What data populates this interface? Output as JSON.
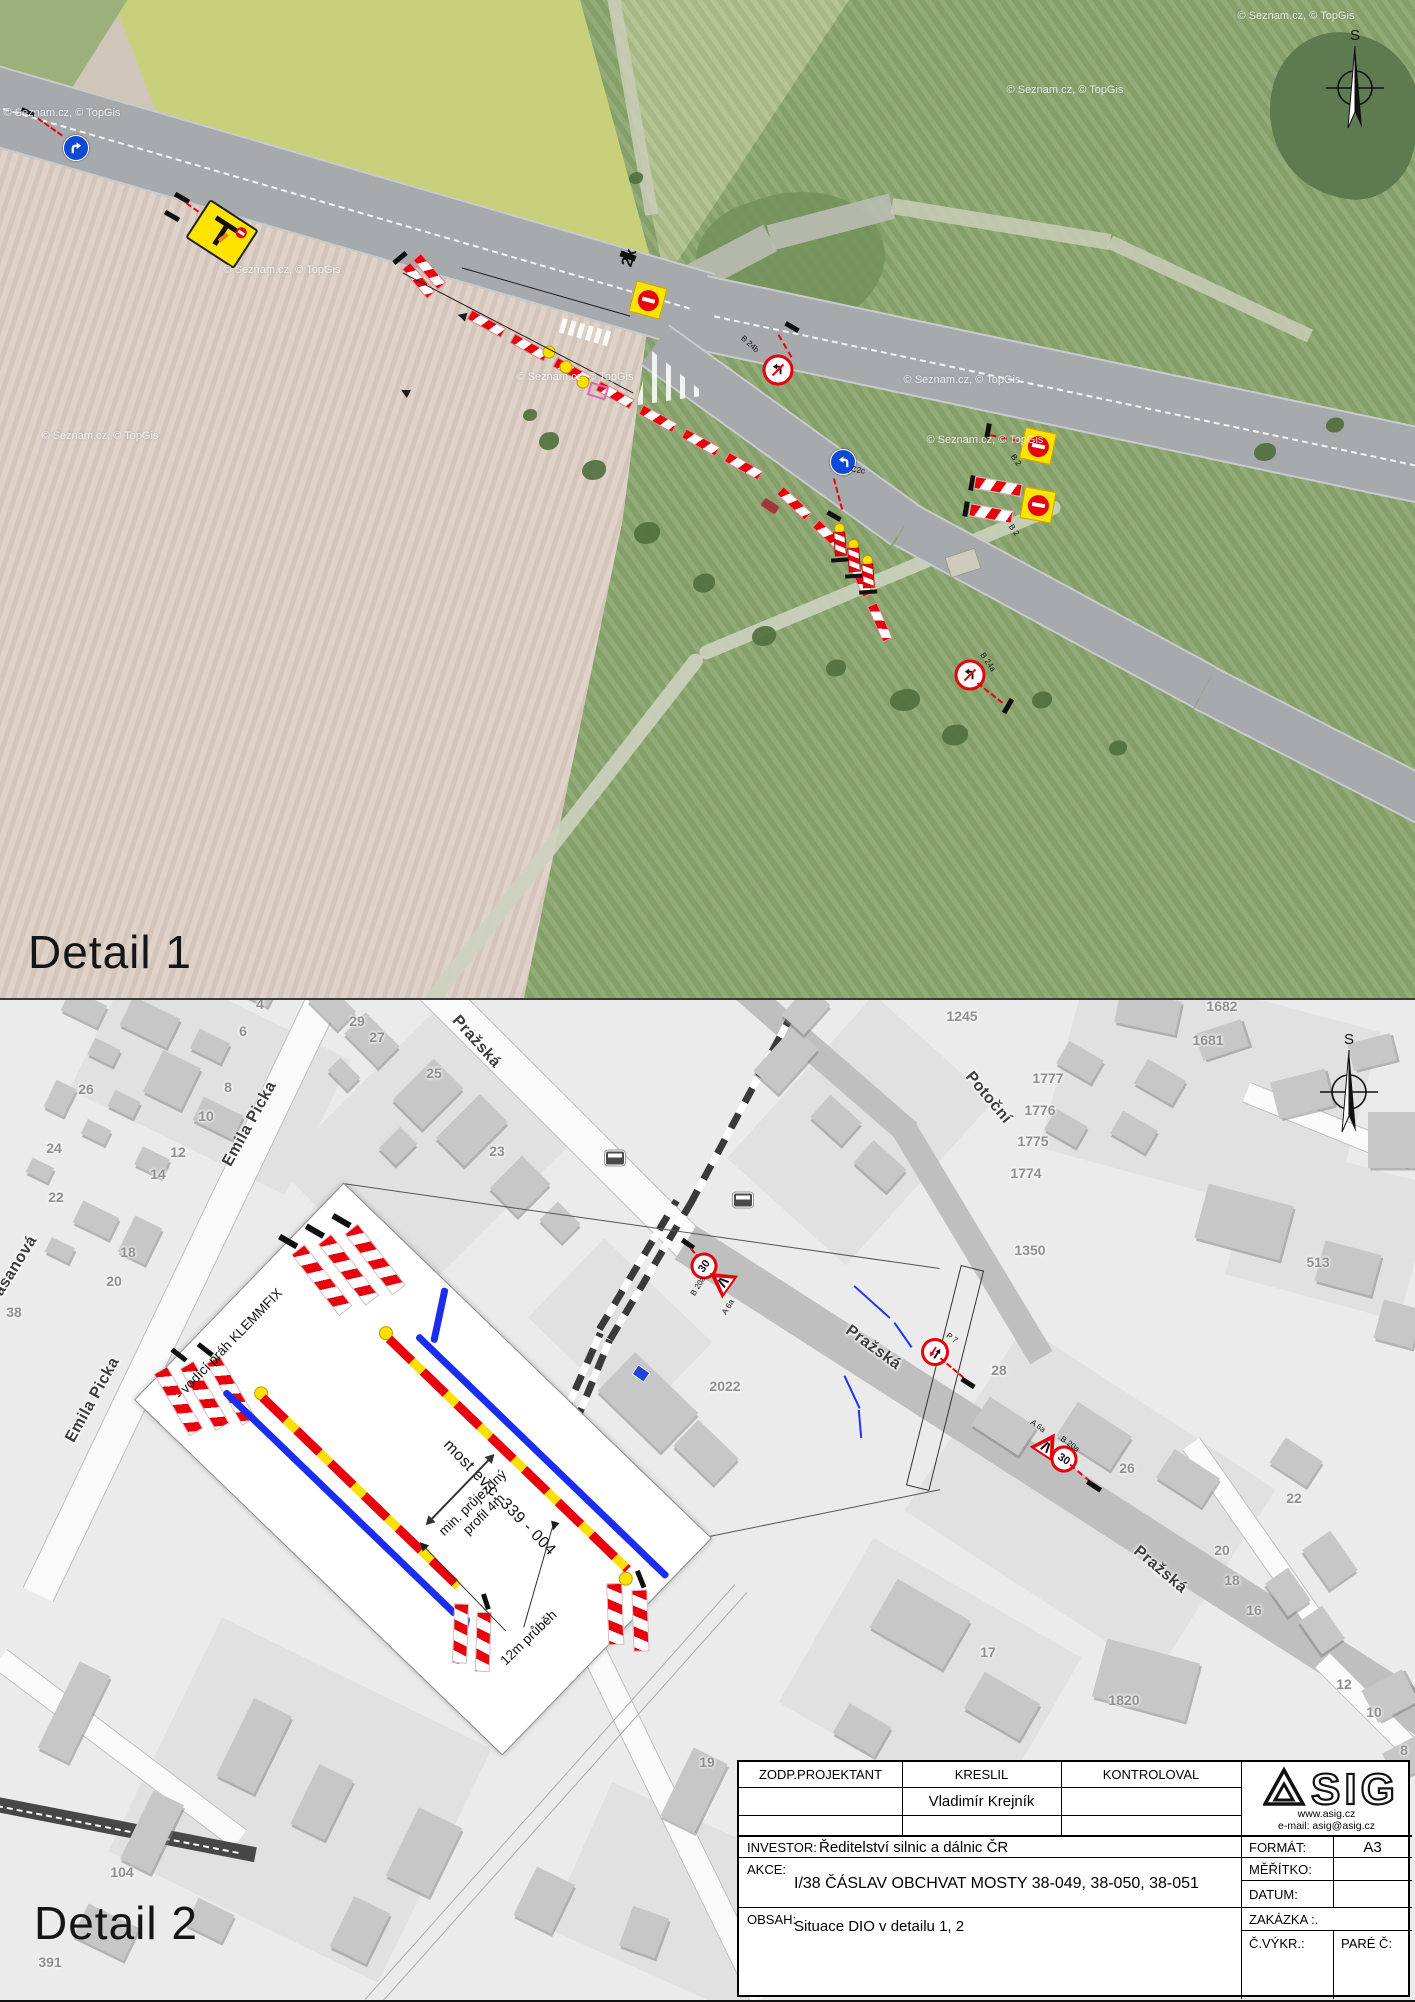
{
  "page": {
    "width": 1415,
    "height": 2000
  },
  "detail1": {
    "title": "Detail 1",
    "compass_label": "S",
    "watermarks": [
      {
        "text": "© Seznam.cz, © TopGis",
        "x": 62,
        "y": 113
      },
      {
        "text": "© Seznam.cz, © TopGis",
        "x": 282,
        "y": 270
      },
      {
        "text": "© Seznam.cz, © TopGis",
        "x": 100,
        "y": 436
      },
      {
        "text": "© Seznam.cz, © TopGis",
        "x": 575,
        "y": 377
      },
      {
        "text": "© Seznam.cz, © TopGis",
        "x": 985,
        "y": 440
      },
      {
        "text": "© Seznam.cz, © TopGis",
        "x": 1065,
        "y": 90
      },
      {
        "text": "© Seznam.cz, © TopGis",
        "x": 1296,
        "y": 16
      },
      {
        "text": "© Seznam.cz, © TopGis",
        "x": 962,
        "y": 380
      }
    ],
    "sign_codes": [
      {
        "text": "2x",
        "x": 630,
        "y": 258,
        "rot": -72,
        "size": 16,
        "bold": true
      },
      {
        "text": "B 24b",
        "x": 750,
        "y": 344,
        "rot": 42,
        "size": 8
      },
      {
        "text": "C2c",
        "x": 858,
        "y": 470,
        "rot": 10,
        "size": 8
      },
      {
        "text": "B 2",
        "x": 1016,
        "y": 460,
        "rot": 55,
        "size": 8
      },
      {
        "text": "B 2",
        "x": 1014,
        "y": 530,
        "rot": 55,
        "size": 8
      },
      {
        "text": "B 24a",
        "x": 988,
        "y": 662,
        "rot": 55,
        "size": 8
      }
    ]
  },
  "detail2": {
    "title": "Detail 2",
    "compass_label": "S",
    "speed_value": "30",
    "street_labels": [
      {
        "text": "Emila Picka",
        "x": 250,
        "y": 1124,
        "rot": -61
      },
      {
        "text": "Emila Picka",
        "x": 93,
        "y": 1400,
        "rot": -61
      },
      {
        "text": "Pražská",
        "x": 476,
        "y": 1042,
        "rot": 48
      },
      {
        "text": "Pražská",
        "x": 873,
        "y": 1348,
        "rot": 36
      },
      {
        "text": "Pražská",
        "x": 1160,
        "y": 1570,
        "rot": 40
      },
      {
        "text": "Potoční",
        "x": 988,
        "y": 1098,
        "rot": 50
      },
      {
        "text": "asanová",
        "x": 16,
        "y": 1266,
        "rot": -58
      }
    ],
    "house_numbers": [
      {
        "text": "4",
        "x": 260,
        "y": 1004
      },
      {
        "text": "6",
        "x": 243,
        "y": 1031
      },
      {
        "text": "8",
        "x": 228,
        "y": 1087
      },
      {
        "text": "10",
        "x": 206,
        "y": 1116
      },
      {
        "text": "12",
        "x": 178,
        "y": 1152
      },
      {
        "text": "14",
        "x": 158,
        "y": 1174
      },
      {
        "text": "18",
        "x": 128,
        "y": 1252
      },
      {
        "text": "20",
        "x": 114,
        "y": 1281
      },
      {
        "text": "22",
        "x": 56,
        "y": 1197
      },
      {
        "text": "24",
        "x": 54,
        "y": 1148
      },
      {
        "text": "26",
        "x": 86,
        "y": 1089
      },
      {
        "text": "38",
        "x": 14,
        "y": 1312
      },
      {
        "text": "29",
        "x": 357,
        "y": 1021
      },
      {
        "text": "27",
        "x": 377,
        "y": 1037
      },
      {
        "text": "25",
        "x": 434,
        "y": 1073
      },
      {
        "text": "23",
        "x": 497,
        "y": 1151
      },
      {
        "text": "1245",
        "x": 962,
        "y": 1016
      },
      {
        "text": "1682",
        "x": 1222,
        "y": 1006
      },
      {
        "text": "1681",
        "x": 1208,
        "y": 1040
      },
      {
        "text": "1777",
        "x": 1048,
        "y": 1078
      },
      {
        "text": "1776",
        "x": 1040,
        "y": 1110
      },
      {
        "text": "1775",
        "x": 1033,
        "y": 1141
      },
      {
        "text": "1774",
        "x": 1026,
        "y": 1173
      },
      {
        "text": "1350",
        "x": 1030,
        "y": 1250
      },
      {
        "text": "513",
        "x": 1318,
        "y": 1262
      },
      {
        "text": "2022",
        "x": 725,
        "y": 1386
      },
      {
        "text": "28",
        "x": 999,
        "y": 1370
      },
      {
        "text": "26",
        "x": 1127,
        "y": 1468
      },
      {
        "text": "22",
        "x": 1294,
        "y": 1498
      },
      {
        "text": "20",
        "x": 1222,
        "y": 1550
      },
      {
        "text": "18",
        "x": 1232,
        "y": 1580
      },
      {
        "text": "16",
        "x": 1254,
        "y": 1610
      },
      {
        "text": "17",
        "x": 988,
        "y": 1652
      },
      {
        "text": "19",
        "x": 707,
        "y": 1762
      },
      {
        "text": "1820",
        "x": 1124,
        "y": 1700
      },
      {
        "text": "104",
        "x": 122,
        "y": 1872
      },
      {
        "text": "391",
        "x": 50,
        "y": 1962
      },
      {
        "text": "12",
        "x": 1344,
        "y": 1684
      },
      {
        "text": "10",
        "x": 1374,
        "y": 1712
      },
      {
        "text": "8",
        "x": 1404,
        "y": 1750
      }
    ],
    "sign_codes": [
      {
        "text": "A 6a",
        "x": 1038,
        "y": 1426,
        "rot": 35,
        "size": 8
      },
      {
        "text": "B 20a",
        "x": 1070,
        "y": 1444,
        "rot": 35,
        "size": 8
      },
      {
        "text": "P 7",
        "x": 952,
        "y": 1338,
        "rot": 35,
        "size": 8
      },
      {
        "text": "B 20a",
        "x": 698,
        "y": 1286,
        "rot": -58,
        "size": 8
      },
      {
        "text": "A 6a",
        "x": 728,
        "y": 1307,
        "rot": -58,
        "size": 8
      }
    ],
    "inset": {
      "klemmfix_label": "- vodící práh KLEMMFIX",
      "bridge_label": "most ev.c. 339 - 004",
      "profile_label": "min. průjezdný profil 4m",
      "length_label": "12m průběh"
    }
  },
  "titleblock": {
    "col1": "ZODP.PROJEKTANT",
    "col2": "KRESLIL",
    "col3": "KONTROLOVAL",
    "kreslil_name": "Vladimír Krejník",
    "investor_label": "INVESTOR:",
    "investor_value": "Ředitelství silnic a dálnic ČR",
    "akce_label": "AKCE:",
    "akce_value": "I/38 ČÁSLAV OBCHVAT MOSTY 38-049, 38-050, 38-051",
    "obsah_label": "OBSAH:",
    "obsah_value": "Situace DIO v detailu 1, 2",
    "format_label": "FORMÁT:",
    "format_value": "A3",
    "meritko_label": "MĚŘÍTKO:",
    "datum_label": "DATUM:",
    "zakazka_label": "ZAKÁZKA :.",
    "cvykr_label": "Č.VÝKR.:",
    "pare_label": "PARÉ Č:",
    "logo_sig": "SIG",
    "logo_web": "www.asig.cz",
    "logo_email": "e-mail: asig@asig.cz"
  }
}
